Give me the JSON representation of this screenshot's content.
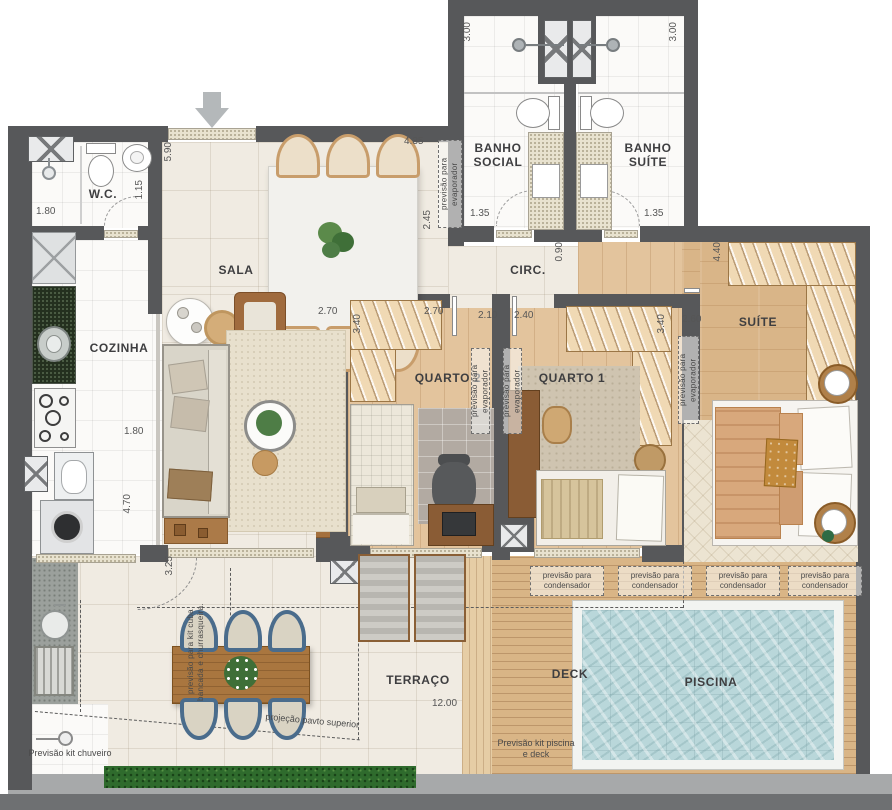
{
  "rooms": {
    "wc": "W.C.",
    "cozinha": "COZINHA",
    "sala": "SALA",
    "circ": "CIRC.",
    "banho_social": "BANHO SOCIAL",
    "banho_suite": "BANHO SUÍTE",
    "quarto2": "QUARTO 2",
    "quarto1": "QUARTO 1",
    "suite": "SUÍTE",
    "terraco": "TERRAÇO",
    "deck": "DECK",
    "piscina": "PISCINA"
  },
  "dims": {
    "wc_w": "1.80",
    "wc_d": "1.15",
    "sala_h": "5.90",
    "sala_w": "4.35",
    "sala_r": "2.45",
    "bs_h": "3.00",
    "bt_h": "3.00",
    "bs_w": "1.35",
    "bt_w": "1.35",
    "circ_w": "0.90",
    "q2_a": "2.70",
    "q2_b": "2.70",
    "q2_closet": "3.40",
    "q2_w": "2.10",
    "q1_w": "2.40",
    "q1_closet": "3.40",
    "suite_w": "2.60",
    "suite_closet": "4.40",
    "coz_w": "1.80",
    "coz_h": "4.70",
    "terr_h": "3.25",
    "terr_w": "12.00"
  },
  "annotations": {
    "evaporador": "previsão para evaporador",
    "condensador": "previsão para condensador",
    "projecao": "projeção pavto superior",
    "kit_piscina": "Previsão kit piscina e deck",
    "kit_chuveiro": "Previsão kit chuveiro",
    "kit_cuba": "previsão para kit cuba bancada e churrasqueira."
  },
  "colors": {
    "wall": "#57585a",
    "floor_tile": "#f0ebe2",
    "floor_white": "#fbfaf8",
    "wood": "#e3c49d",
    "deck": "#d9b586",
    "pool_water": "#b9d7da",
    "granite": "#e8e2cf",
    "grass": "#2f6b2d",
    "chairs_blue": "#4a6c8c"
  }
}
